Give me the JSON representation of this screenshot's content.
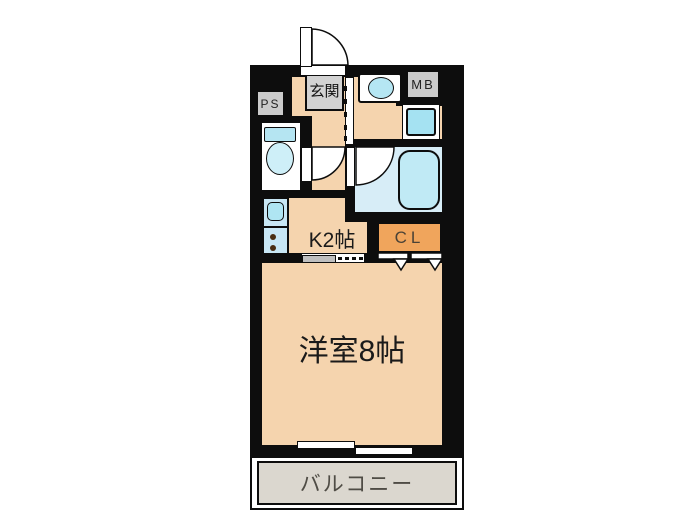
{
  "plan": {
    "rooms": {
      "entrance": {
        "label": "玄関"
      },
      "pipe_space": {
        "label": "PS"
      },
      "meter_box": {
        "label": "MB"
      },
      "kitchen": {
        "label": "K2帖"
      },
      "closet": {
        "label": "CL"
      },
      "main_room": {
        "label": "洋室8帖"
      },
      "balcony": {
        "label": "バルコニー"
      }
    },
    "fixtures": {
      "entrance_door": "swing-door",
      "toilet": "toilet",
      "bathtub": "bathtub",
      "washbasin": "washbasin",
      "washing_machine_pan": "washing-machine-pan",
      "kitchen_counter": "sink-and-two-burner-stove",
      "toilet_door": "swing-door",
      "bath_door": "swing-door",
      "hall_sliding_door": "sliding-door",
      "kitchen_partition": "sliding-partition",
      "closet_doors": "bi-fold-doors",
      "balcony_window": "sliding-window"
    },
    "colors": {
      "wall": "#0d0d0d",
      "floor_peach": "#f5d4ae",
      "wet_area_blue": "#d7edf7",
      "fixture_blue": "#bce7f4",
      "closet_orange": "#f0a55c",
      "utility_gray": "#cbcbcb",
      "balcony_gray": "#dbd7cf"
    }
  }
}
